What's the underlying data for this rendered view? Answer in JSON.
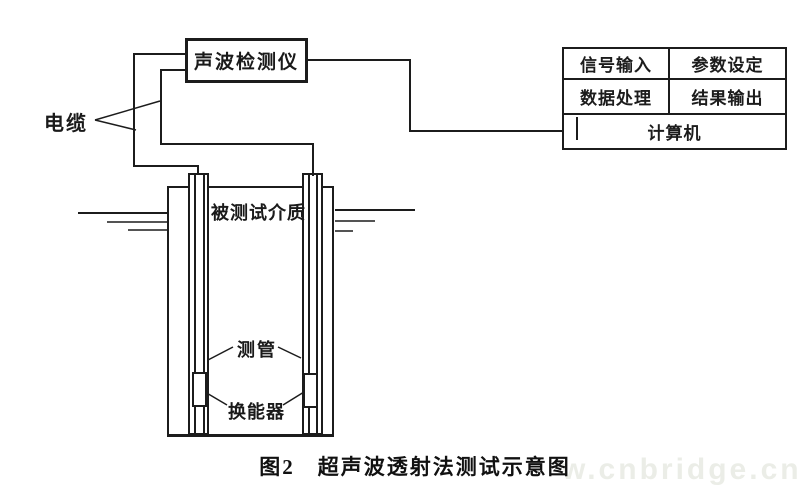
{
  "figure": {
    "caption": "图2　超声波透射法测试示意图",
    "watermark": "w.cnbridge.cn"
  },
  "detector_box": {
    "label": "声波检测仪"
  },
  "computer_table": {
    "row1": [
      "信号输入",
      "参数设定"
    ],
    "row2": [
      "数据处理",
      "结果输出"
    ],
    "row3": "计算机"
  },
  "labels": {
    "cable": "电缆",
    "medium": "被测试介质",
    "tube": "测管",
    "transducer": "换能器"
  },
  "colors": {
    "line": "#1c1c1c",
    "background": "#ffffff",
    "watermark_text": "#ebede7"
  }
}
